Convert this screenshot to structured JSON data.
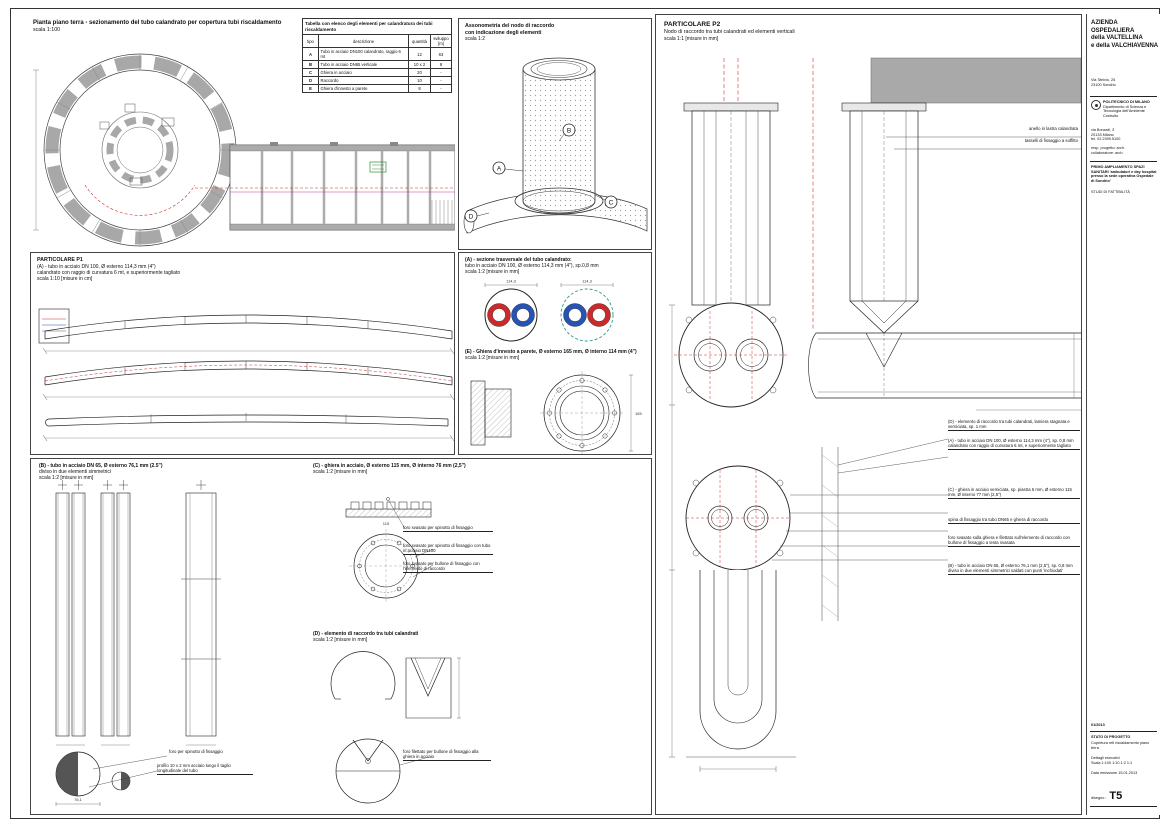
{
  "plan": {
    "title": "Pianta piano terra - sezionamento del tubo calandrato per copertura tubi riscaldamento",
    "scale": "scala 1:100"
  },
  "table": {
    "title": "Tabella con elenco degli elementi per calandratura dei tubi riscaldamento",
    "col_tipo": "tipo",
    "col_desc": "descrizione",
    "col_qty": "quantità",
    "col_len": "sviluppo [m]",
    "rows": [
      [
        "A",
        "Tubo in acciaio DN100 calandrato, raggio 6 mt",
        "12",
        "63"
      ],
      [
        "B",
        "Tubo in acciaio DN65 verticale",
        "10 x 2",
        "8"
      ],
      [
        "C",
        "Ghiera in acciaio",
        "20",
        "-"
      ],
      [
        "D",
        "Raccordo",
        "10",
        "-"
      ],
      [
        "E",
        "Ghiera d'innesto a parete",
        "8",
        "-"
      ]
    ]
  },
  "axon": {
    "title1": "Assonometria del nodo di raccordo",
    "title2": "con indicazione degli elementi",
    "scale": "scala 1:2",
    "callouts": [
      "A",
      "B",
      "C",
      "D"
    ]
  },
  "p1": {
    "title": "PARTICOLARE P1",
    "line1": "(A) - tubo in acciaio DN 100, Ø esterno 114,3 mm (4\")",
    "line2": "calandrato con raggio di curvatura 6 mt, e superiormente tagliato",
    "scale": "scala 1:10 [misure in cm]"
  },
  "secA": {
    "title1": "(A) - sezione trasversale del tubo calandrato:",
    "title2": "tubo in acciaio DN 100, Ø esterno 114,3 mm (4\"), sp.0,8 mm",
    "scale": "scala 1:2 [misure in mm]"
  },
  "secE": {
    "title": "(E) - Ghiera d'innesto a parete, Ø esterno 165 mm, Ø interno 114 mm (4\")",
    "scale": "scala 1:2 [misure in mm]"
  },
  "secB": {
    "title1": "(B) - tubo in acciaio DN 65, Ø esterno 76,1 mm (2.5\")",
    "title2": "diviso in due elementi simmetrici",
    "scale": "scala 1:2 [misure in mm]",
    "note1": "foro per spinotto di fissaggio",
    "note2": "profilo 10 x 2 mm acciaio lungo il taglio longitudinale del tubo"
  },
  "secC": {
    "title1": "(C) - ghiera in acciaio, Ø esterno 115 mm, Ø interno 76 mm (2,5\")",
    "scale": "scala 1:2 [misure in mm]",
    "notes": [
      "foro svasato per spinotto di fissaggio",
      "foro svasato per spinotto di fissaggio con tubo in acciaio DN100",
      "foro svasato per bullone di fissaggio con l'elemento di raccordo"
    ]
  },
  "secD": {
    "title1": "(D) - elemento di raccordo tra tubi calandrati",
    "scale": "scala 1:2 [misure in mm]",
    "note": "foro filettato per bullone di fissaggio alla ghiera in acciaio"
  },
  "p2": {
    "title": "PARTICOLARE P2",
    "subtitle": "Nodo di raccordo tra tubi calandrati ed elementi verticali",
    "scale": "scala 1:1 [misure in mm]",
    "note_top1": "anello in lastra calandrata",
    "note_top2": "tasselli di fissaggio a soffitto",
    "annotations": [
      "(D) - elemento di raccordo tra tubi calandrati, lamiera stagnata e verniciata, sp. 1 mm",
      "(A) - tubo in acciaio DN 100, Ø esterno 114,3 mm (4\"), sp. 0,8 mm calandrato con raggio di curvatura 6 mt, e superiormente tagliato",
      "(C) - ghiera in acciaio verniciata, sp. piastra 5 mm, Ø esterno 115 mm, Ø interno 77 mm (2,5\")",
      "spina di fissaggio tra tubo DN65 e ghiera di raccordo",
      "foro svasato sulla ghiera e filettato sull'elemento di raccordo con bullone di fissaggio a testa svasata",
      "(B) - tubo in acciaio DN 65, Ø esterno 76,1 mm (2,5\"), sp. 0,8 mm diviso in due elementi simmetrici saldati con punti 'inchiodati'"
    ]
  },
  "dims": {
    "secA_left": "114,3",
    "secA_right": "114,3",
    "secE": "165",
    "secB": "76,1",
    "secC": "115"
  },
  "titleblock": {
    "org1": "AZIENDA OSPEDALIERA",
    "org2": "della VALTELLINA",
    "org3": "e della VALCHIAVENNA",
    "addr1": "Via Stelvio, 25",
    "addr2": "23100 Sondrio",
    "uni1": "POLITECNICO DI MILANO",
    "uni2": "Dipartimento di Scienza e Tecnologia dell'Ambiente Costruito",
    "uni_addr1": "via Bonardi, 3",
    "uni_addr2": "20133 Milano",
    "uni_addr3": "tel. 02.2399.5100",
    "team1": "resp. progetto: arch.",
    "team2": "collaboratore: arch.",
    "project": "PRIMO AMPLIAMENTO SPAZI SANITARI 'ambulatori e day hospital presso la sede operativa Ospedale di Sondrio'",
    "phase": "STUDI DI FATTIBILITÀ",
    "code": "01/2013",
    "stato": "STATO DI PROGETTO",
    "subject": "Copertura reti riscaldamento piano terra",
    "detail": "Dettagli esecutivi",
    "scales": "Scala 1:100 1:10 1:2 1:1",
    "issue": "Data emissione 15.01.2013",
    "drawing_label": "disegno :",
    "drawing_no": "T5"
  }
}
